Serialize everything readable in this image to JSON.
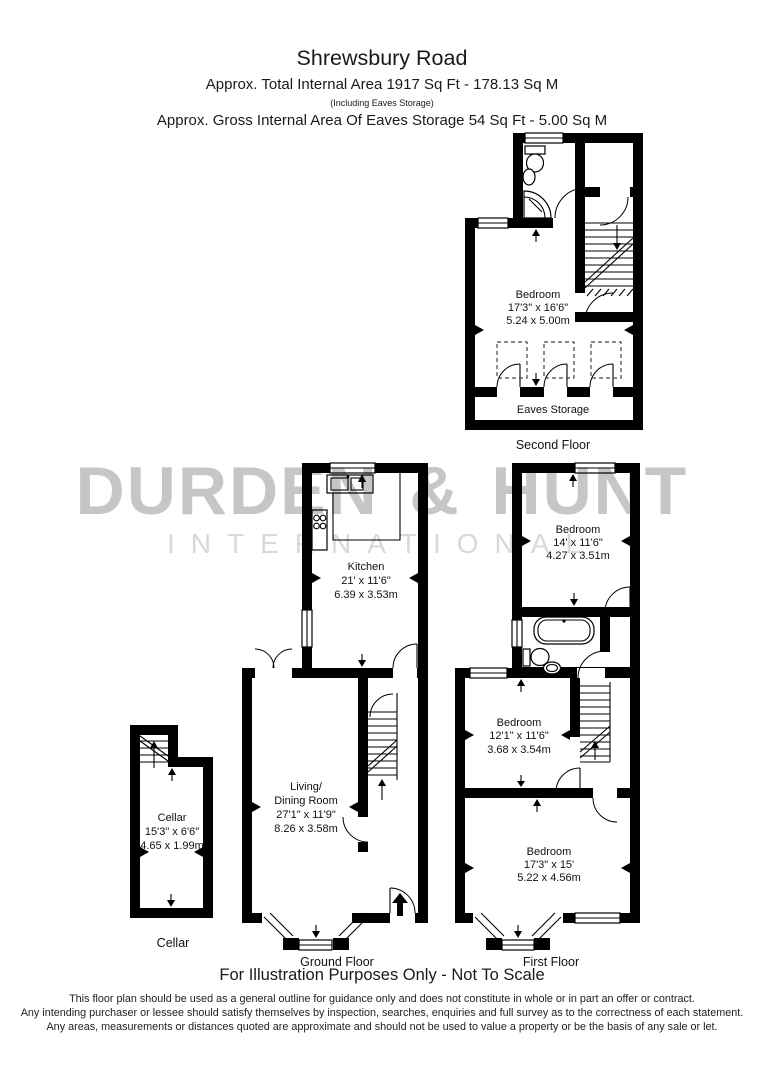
{
  "header": {
    "title": "Shrewsbury Road",
    "line1": "Approx. Total Internal Area   1917 Sq Ft  -  178.13 Sq M",
    "note": "(Including Eaves Storage)",
    "line2": "Approx. Gross Internal Area Of Eaves Storage  54 Sq Ft  -  5.00 Sq M"
  },
  "watermark": {
    "name": "DURDEN & HUNT",
    "sub": "INTERNATIONAL"
  },
  "labels": {
    "second_bedroom": {
      "name": "Bedroom",
      "ft": "17'3\" x 16'6\"",
      "m": "5.24 x 5.00m"
    },
    "eaves": {
      "name": "Eaves Storage"
    },
    "kitchen": {
      "name": "Kitchen",
      "ft": "21' x 11'6\"",
      "m": "6.39 x 3.53m"
    },
    "living": {
      "name": "Living/",
      "name2": "Dining Room",
      "ft": "27'1\" x 11'9\"",
      "m": "8.26 x 3.58m"
    },
    "bed_front": {
      "name": "Bedroom",
      "ft": "14' x 11'6\"",
      "m": "4.27 x 3.51m"
    },
    "bed_middle": {
      "name": "Bedroom",
      "ft": "12'1\" x 11'6\"",
      "m": "3.68 x 3.54m"
    },
    "bed_rear": {
      "name": "Bedroom",
      "ft": "17'3\" x 15'",
      "m": "5.22 x 4.56m"
    },
    "cellar_room": {
      "name": "Cellar",
      "ft": "15'3\" x 6'6\"",
      "m": "4.65 x 1.99m"
    }
  },
  "floor_labels": {
    "second": "Second Floor",
    "ground": "Ground Floor",
    "first": "First Floor",
    "cellar": "Cellar"
  },
  "footer": {
    "illustration": "For Illustration Purposes Only - Not To Scale",
    "line1": "This floor plan should be used as a general outline for guidance only and does not constitute in whole or in part an offer or contract.",
    "line2": "Any intending purchaser or lessee should satisfy themselves by inspection, searches, enquiries and full survey as to the correctness of each statement.",
    "line3": "Any areas, measurements or distances quoted are approximate and should not be used to value a property or be the basis of any sale or let."
  }
}
